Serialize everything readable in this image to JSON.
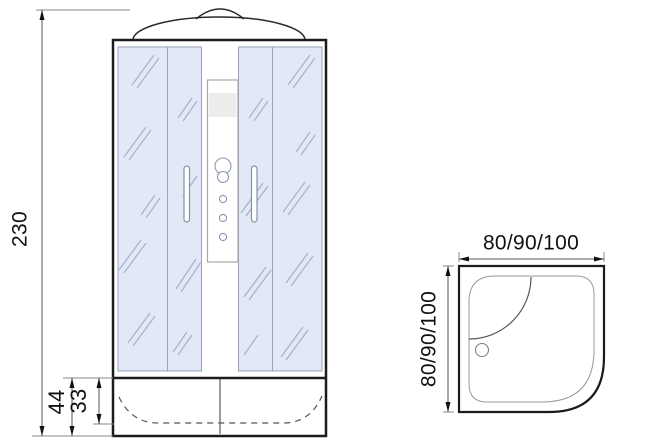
{
  "front_view": {
    "height_label": "230",
    "base_height_label": "44",
    "tray_depth_label": "33"
  },
  "plan_view": {
    "width_label": "80/90/100",
    "depth_label": "80/90/100"
  },
  "colors": {
    "outline": "#1c1c1c",
    "glass_fill": "#e3e8f6",
    "glass_stroke": "#99a3bc",
    "hatch": "#a9b3cb",
    "dimension_line": "#555555",
    "extension_line": "#8a8a8a",
    "label_text": "#111111",
    "column_band": "#ececec"
  }
}
